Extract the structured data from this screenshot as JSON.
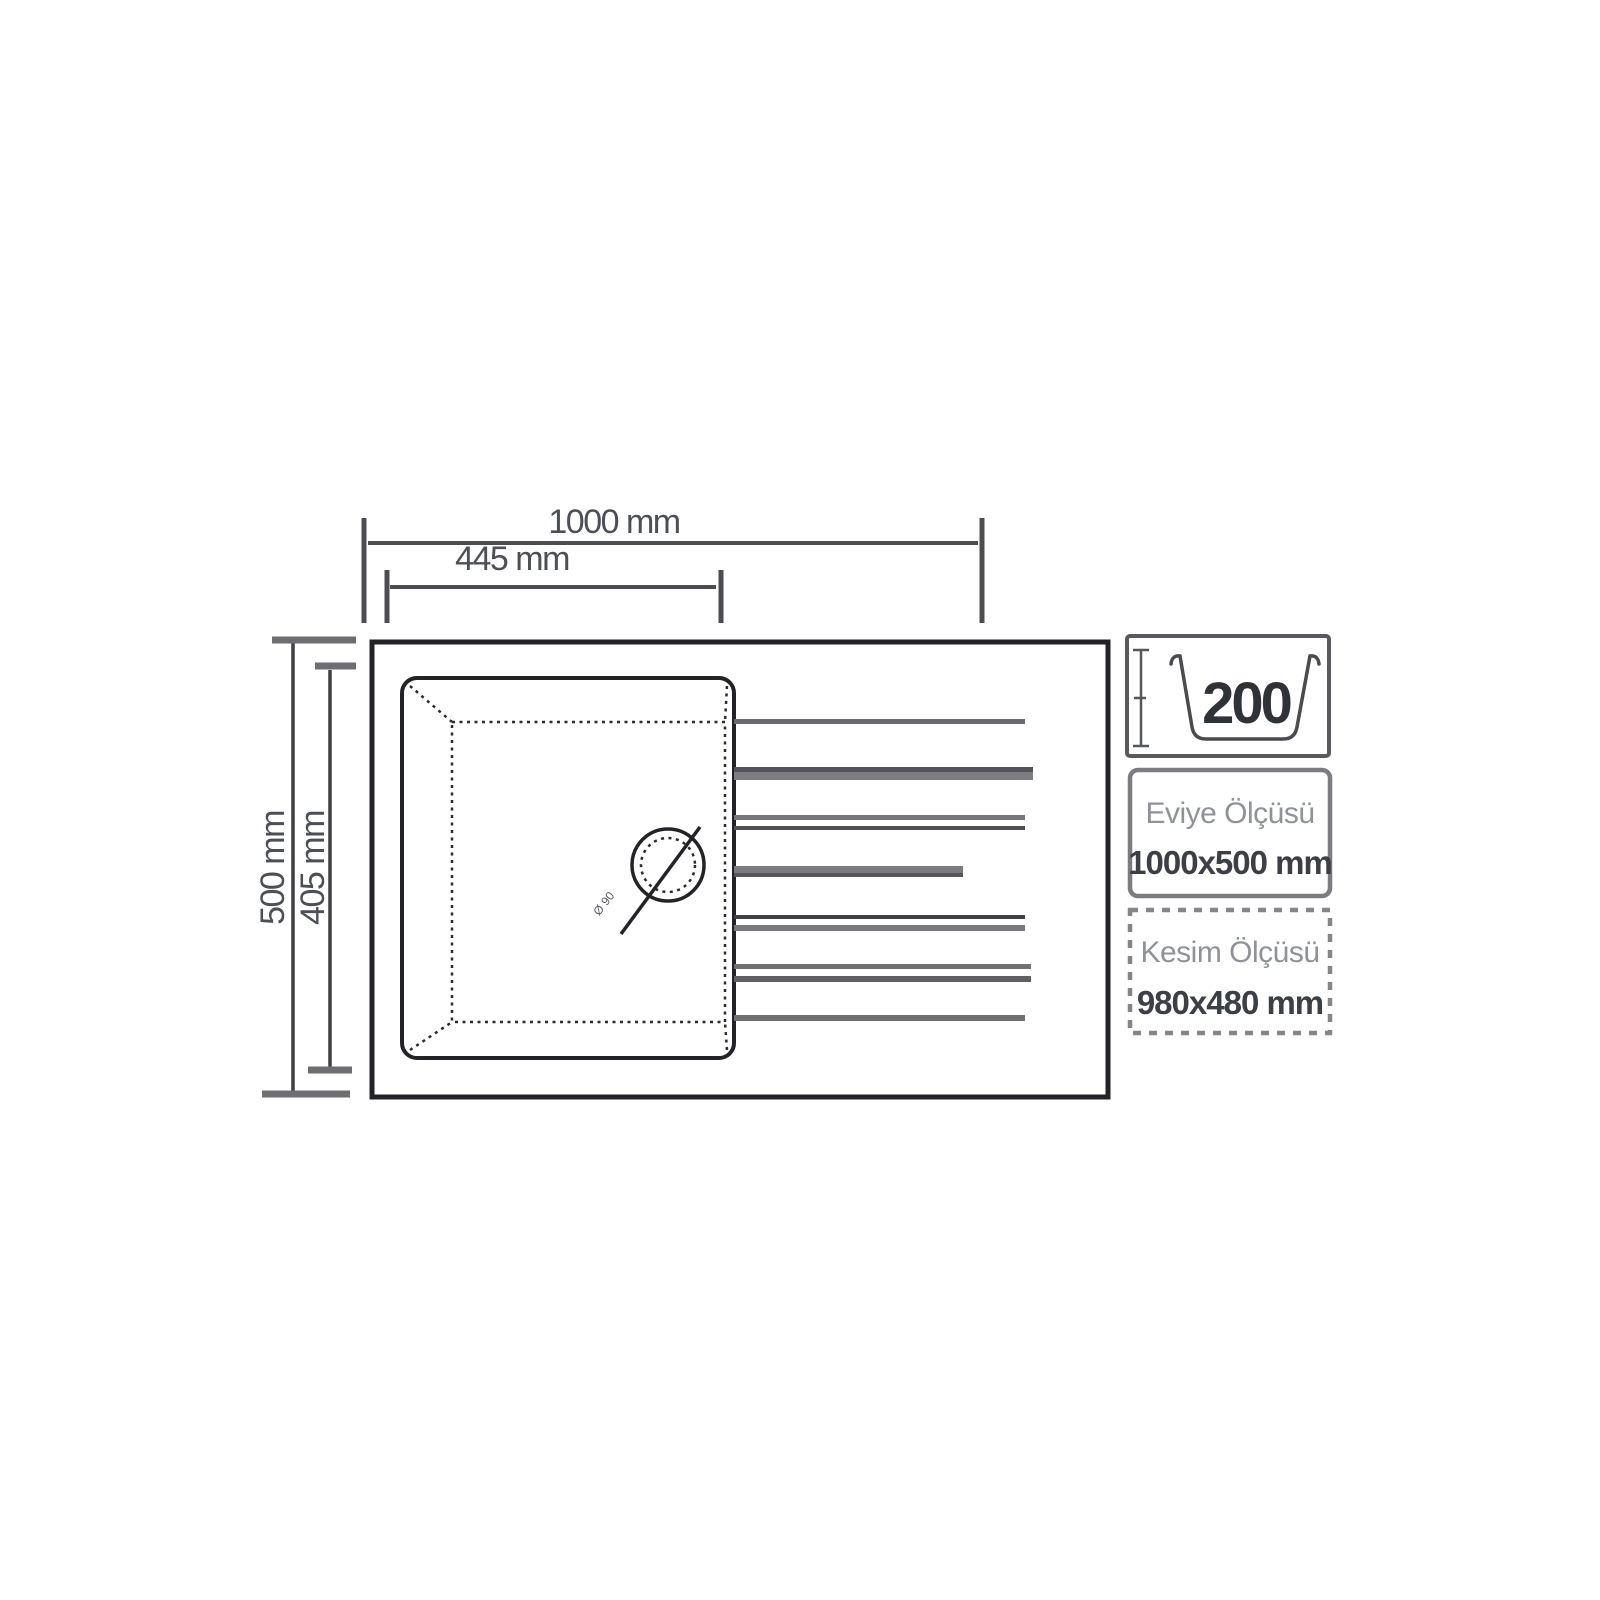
{
  "drawing": {
    "dimensions": {
      "overall_width": "1000 mm",
      "bowl_width": "445 mm",
      "overall_depth": "500 mm",
      "bowl_depth": "405 mm",
      "drain_label": "Ø 90"
    },
    "side_panel": {
      "depth_badge": {
        "value": "200"
      },
      "sink_size": {
        "label": "Eviye Ölçüsü",
        "value": "1000x500 mm"
      },
      "cut_size": {
        "label": "Kesim Ölçüsü",
        "value": "980x480 mm"
      }
    },
    "colors": {
      "background": "#ffffff",
      "outline": "#232327",
      "dimension_gray": "#6d6d72",
      "value_text": "#3c4046",
      "muted_text": "#8f9297"
    }
  }
}
